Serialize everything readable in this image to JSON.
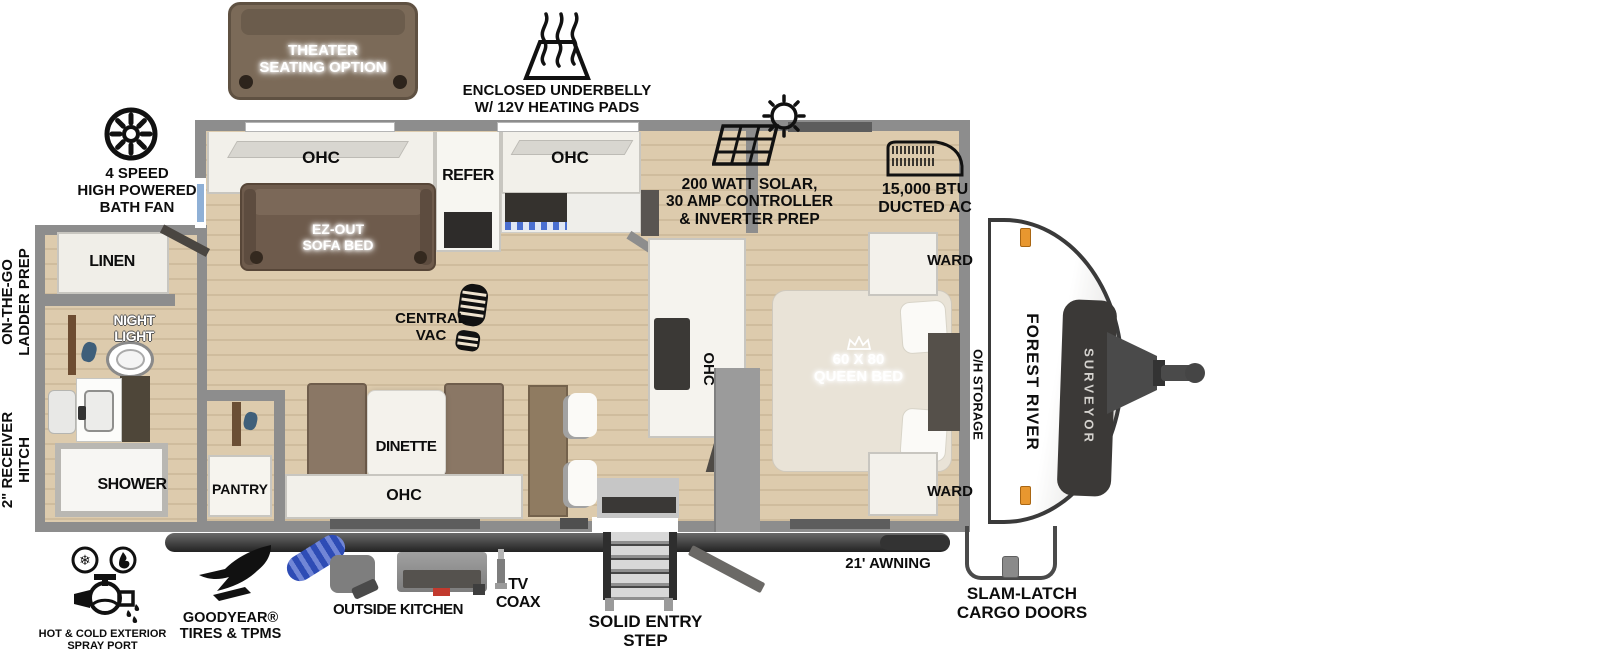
{
  "callouts": {
    "theater": {
      "l1": "THEATER",
      "l2": "SEATING OPTION"
    },
    "underbelly": {
      "l1": "ENCLOSED UNDERBELLY",
      "l2": "W/ 12V HEATING PADS"
    },
    "bath_fan": {
      "l1": "4 SPEED",
      "l2": "HIGH POWERED",
      "l3": "BATH FAN"
    },
    "solar": {
      "l1": "200 WATT SOLAR,",
      "l2": "30 AMP CONTROLLER",
      "l3": "& INVERTER PREP"
    },
    "ac": {
      "l1": "15,000 BTU",
      "l2": "DUCTED AC"
    },
    "ladder": {
      "l1": "ON-THE-GO",
      "l2": "LADDER PREP"
    },
    "hitch": {
      "l1": "2\" RECEIVER",
      "l2": "HITCH"
    },
    "spray": {
      "l1": "HOT & COLD EXTERIOR",
      "l2": "SPRAY PORT"
    },
    "goodyear": {
      "l1": "GOODYEAR®",
      "l2": "TIRES & TPMS"
    },
    "outside_kitchen": "OUTSIDE KITCHEN",
    "coax": {
      "l1": "TV",
      "l2": "COAX"
    },
    "step": {
      "l1": "SOLID ENTRY",
      "l2": "STEP"
    },
    "awning": "21' AWNING",
    "cargo": {
      "l1": "SLAM-LATCH",
      "l2": "CARGO DOORS"
    }
  },
  "interior": {
    "ohc_rear": "OHC",
    "refer": "REFER",
    "ohc_kitchen": "OHC",
    "sofa": {
      "l1": "EZ-OUT",
      "l2": "SOFA BED"
    },
    "vac": {
      "l1": "CENTRAL",
      "l2": "VAC"
    },
    "linen": "LINEN",
    "night_light": {
      "l1": "NIGHT",
      "l2": "LIGHT"
    },
    "shower": "SHOWER",
    "pantry": "PANTRY",
    "dinette": "DINETTE",
    "ohc_dinette": "OHC",
    "ohc_tv": "OHC",
    "bed": {
      "l1": "60 X 80",
      "l2": "QUEEN BED"
    },
    "ward_top": "WARD",
    "ward_bottom": "WARD",
    "oh_storage": "O/H STORAGE"
  },
  "branding": {
    "make": "FOREST RIVER",
    "model": "SURVEYOR"
  },
  "colors": {
    "wall": "#8d8d8d",
    "floor": "#ddcbad",
    "sofa_brown": "#6e5b4c",
    "bench_brown": "#8a7765",
    "awning_tube": "#3f3f3f",
    "hose_blue": "#2e4cb5",
    "marker_light": "#e8972f",
    "cooktop_blue": "#4a6fd0"
  }
}
